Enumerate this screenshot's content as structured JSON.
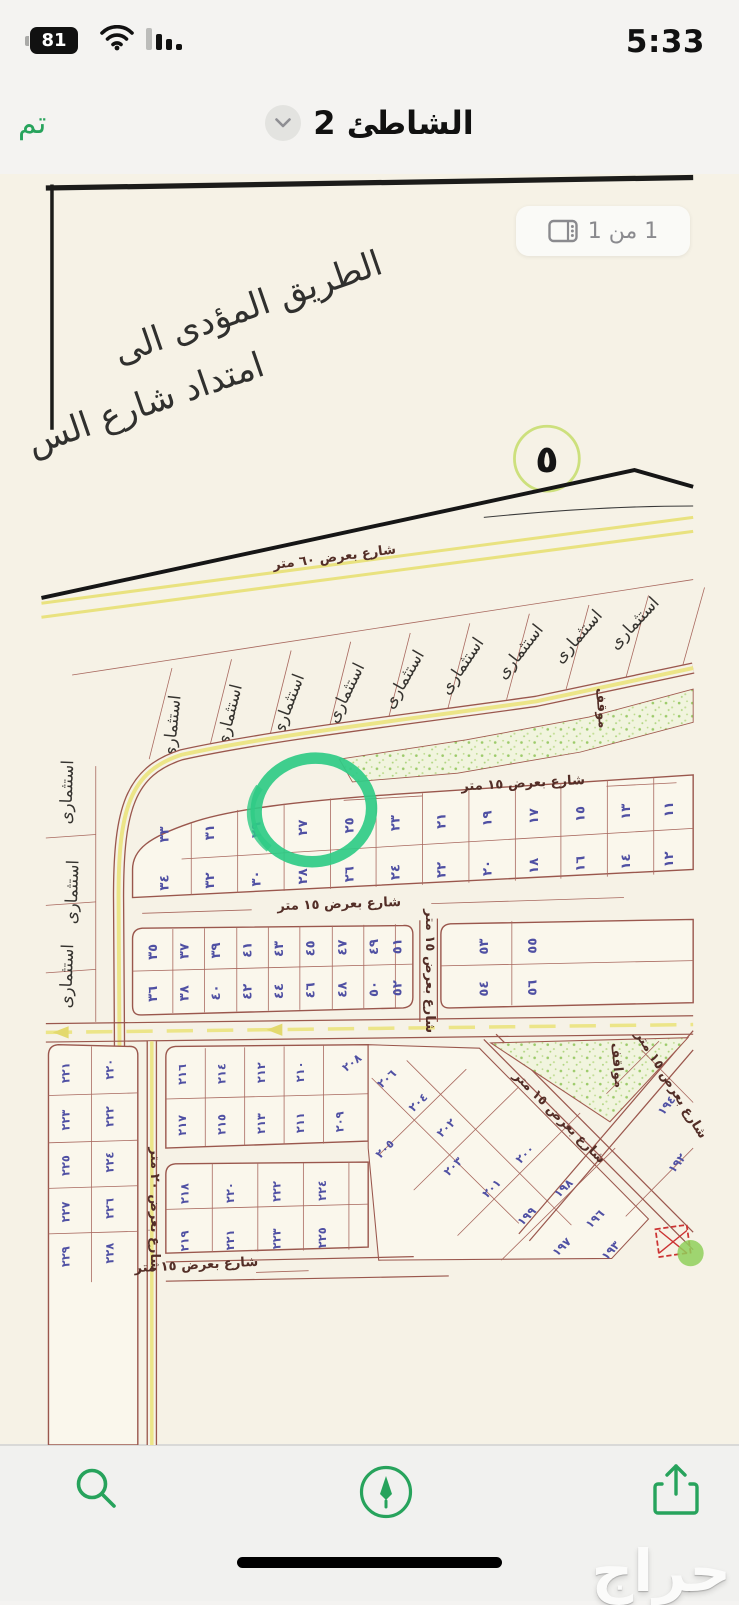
{
  "status_bar": {
    "battery_percent": "81",
    "time": "5:33"
  },
  "nav_bar": {
    "done_label": "تم",
    "title": "الشاطئ 2"
  },
  "page_indicator": {
    "label": "1 من 1"
  },
  "colors": {
    "accent_green": "#27a35c",
    "annotation_green": "#2fcb86",
    "paper": "#f6f2e6",
    "plot_number_ink": "#4f50a3",
    "map_line_maroon": "#9a574d",
    "road_yellow": "#ece588"
  },
  "map": {
    "handwriting_line1": "الطريق المؤدى الى",
    "handwriting_line2": "امتداد شارع الس",
    "circled_number": "٥",
    "investment_label": "استثمارى",
    "parking_label_small": "موقف",
    "parking_label_triangle": "مواقف",
    "streets": {
      "w60": "شارع بعرض ٦٠ متر",
      "w15": "شارع بعرض ١٥ متر",
      "w20": "شارع بعرض ٢٠ متر"
    },
    "plots": {
      "block1_top": [
        "٣٣",
        "٣١",
        "٢٩",
        "٢٧",
        "٢٥",
        "٢٣",
        "٢١",
        "١٩",
        "١٧",
        "١٥",
        "١٣",
        "١١"
      ],
      "block1_bottom": [
        "٣٤",
        "٣٢",
        "٣٠",
        "٢٨",
        "٢٦",
        "٢٤",
        "٢٢",
        "٢٠",
        "١٨",
        "١٦",
        "١٤",
        "١٢"
      ],
      "block2_top": [
        "٣٥",
        "٣٧",
        "٣٩",
        "٤١",
        "٤٣",
        "٤٥",
        "٤٧",
        "٤٩",
        "٥١"
      ],
      "block2_bottom": [
        "٣٦",
        "٣٨",
        "٤٠",
        "٤٢",
        "٤٤",
        "٤٦",
        "٤٨",
        "٥٠",
        "٥٢"
      ],
      "block2_right_top": [
        "٥٣",
        "٥٥"
      ],
      "block2_right_bottom": [
        "٥٤",
        "٥٦"
      ],
      "left_block": [
        "٢٢١",
        "٢٢٠",
        "٢٢٣",
        "٢٢٢",
        "٢٢٥",
        "٢٢٤",
        "٢٢٧",
        "٢٢٦",
        "٢٢٩",
        "٢٢٨"
      ],
      "mid_block_top": [
        "٢١٦",
        "٢١٤",
        "٢١٢",
        "٢١٠"
      ],
      "mid_block_bottom": [
        "٢١٧",
        "٢١٥",
        "٢١٣",
        "٢١١",
        "٢٠٩"
      ],
      "bottom_block_top": [
        "٢١٨",
        "٢٢٠",
        "٢٢٢",
        "٢٢٤"
      ],
      "bottom_block_bottom": [
        "٢١٩",
        "٢٢١",
        "٢٢٣",
        "٢٢٥"
      ],
      "diagonal": [
        "٢٠٨",
        "٢٠٦",
        "٢٠٤",
        "٢٠٢",
        "٢٠٥",
        "٢٠٣",
        "٢٠١",
        "٢٠٠",
        "١٩٩",
        "١٩٨",
        "١٩٧",
        "١٩٦",
        "١٩٤",
        "١٩٢",
        "١٩٣"
      ]
    }
  },
  "toolbar": {
    "icons": [
      "search",
      "markup",
      "share"
    ]
  },
  "watermark": "حراج"
}
